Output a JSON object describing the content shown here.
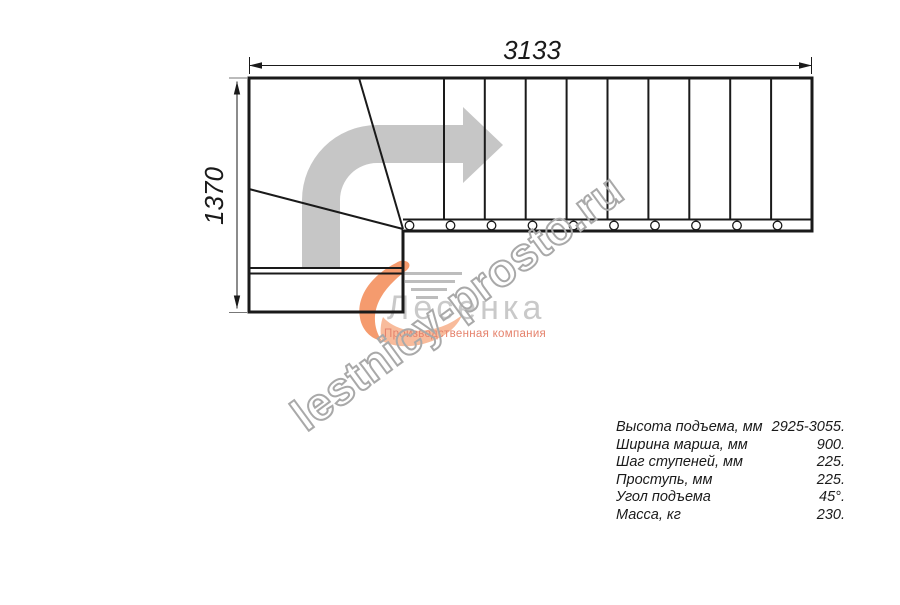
{
  "drawing": {
    "width_label": "3133",
    "height_label": "1370"
  },
  "logo": {
    "name": "Лесенка",
    "tagline": "Производственная компания"
  },
  "watermark": {
    "text": "lestnicy-prosto.ru"
  },
  "specs": {
    "rows": [
      {
        "label": "Высота подъема, мм",
        "value": "2925-3055."
      },
      {
        "label": "Ширина марша, мм",
        "value": "900."
      },
      {
        "label": "Шаг ступеней, мм",
        "value": "225."
      },
      {
        "label": "Проступь, мм",
        "value": "225."
      },
      {
        "label": "Угол подъема",
        "value": "45°."
      },
      {
        "label": "Масса, кг",
        "value": "230."
      }
    ]
  },
  "colors": {
    "ink": "#1a1a1a",
    "arrow-gray": "#c6c6c6",
    "logo-gray": "#c9c9c9",
    "swoosh-orange": "#f59b6e",
    "swoosh-light": "#f8bb9b",
    "tagline-salmon": "#e5826c",
    "watermark-gray": "#a9a9a9",
    "speedline-gray": "#bdbdbd"
  }
}
